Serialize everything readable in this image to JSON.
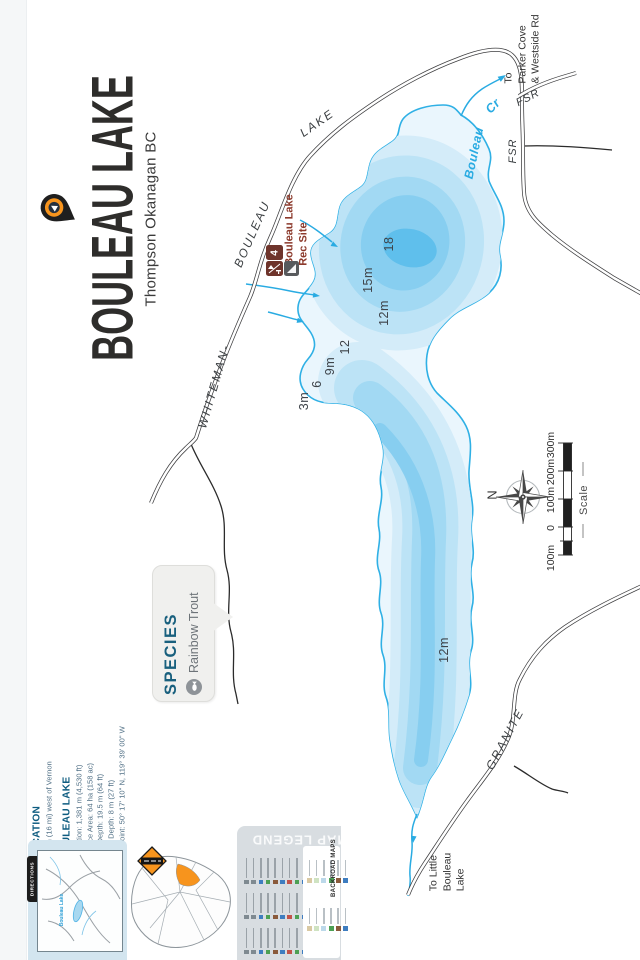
{
  "title": {
    "main": "BOULEAU LAKE",
    "subtitle": "Thompson Okanagan BC"
  },
  "colors": {
    "accent_orange": "#F7941D",
    "water": "#29ABE2",
    "rec_brown": "#6E342B",
    "header_blue": "#0E5C80",
    "species_teal": "#19607E"
  },
  "map_labels": {
    "whiteman": "WHITEMAN-",
    "bouleau_road": "BOULEAU",
    "lake_road": "LAKE",
    "fsr_branch": "FSR",
    "fsr_main": "FSR",
    "granite": "GRANITE",
    "creek_name": "Bouleau",
    "creek_abbr": "Cr",
    "to_parker_1": "To",
    "to_parker_2": "Parker Cove",
    "to_parker_3": "& Westside Rd",
    "to_little_1": "To Little",
    "to_little_2": "Bouleau",
    "to_little_3": "Lake"
  },
  "depths": {
    "d18": "18",
    "d15": "15m",
    "d12a": "12m",
    "d12b": "12",
    "d9": "9m",
    "d6": "6",
    "d3": "3m",
    "d12s": "12m"
  },
  "rec_site": {
    "line1": "Bouleau Lake",
    "line2": "Rec Site",
    "number": "4"
  },
  "species": {
    "header": "SPECIES",
    "item": "Rainbow Trout"
  },
  "compass": {
    "north": "N"
  },
  "scale": {
    "label": "Scale",
    "tick_300": "300m",
    "tick_200": "200m",
    "tick_100": "100m",
    "tick_0": "0",
    "tick_ext": "100m"
  },
  "info": {
    "location_header": "LOCATION",
    "location_text": "26 km (16 mi) west of Vernon",
    "lake_header": "BOULEAU LAKE",
    "elevation": "Elevation: 1,381 m (4,530 ft)",
    "surface_area": "Surface Area: 64 ha (158 ac)",
    "max_depth": "Max Depth: 19.5 m (64 ft)",
    "mean_depth": "Mean Depth: 8 m (27 ft)",
    "waypoint": "Waypoint: 50° 17' 10\" N, 119° 39' 00\" W"
  },
  "footer": {
    "directions_tab": "DIRECTIONS",
    "inset_lake_label": "Bouleau Lake",
    "legend_title": "MAP LEGEND",
    "brand": "BACKROAD MAPS"
  }
}
